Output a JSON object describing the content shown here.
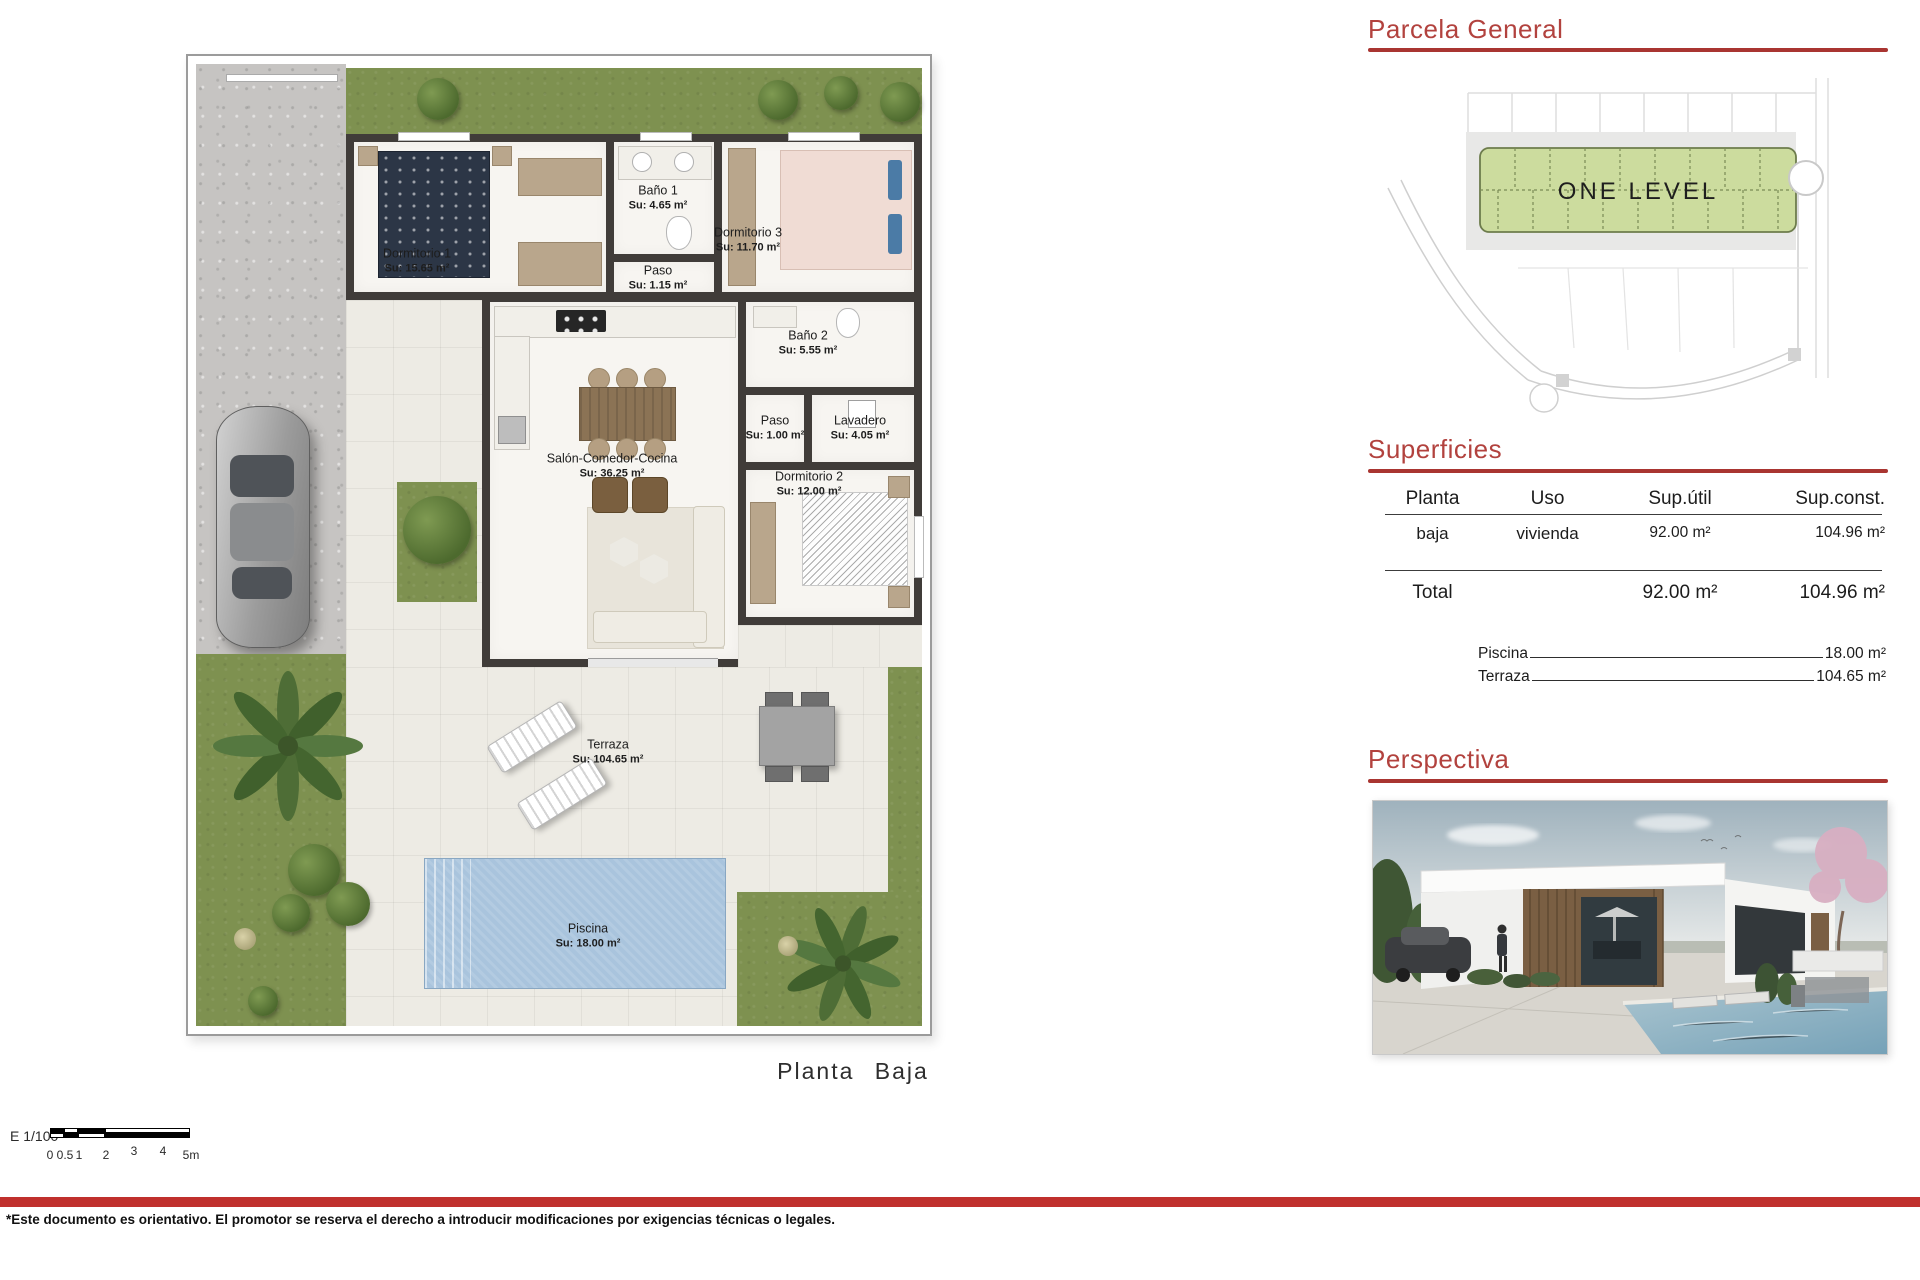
{
  "floor_plan": {
    "title": "Planta  Baja",
    "rooms": [
      {
        "name": "Dormitorio 1",
        "area": "Su: 15.65 m²"
      },
      {
        "name": "Baño 1",
        "area": "Su: 4.65 m²"
      },
      {
        "name": "Dormitorio 3",
        "area": "Su: 11.70 m²"
      },
      {
        "name": "Paso",
        "area": "Su: 1.15 m²"
      },
      {
        "name": "Baño 2",
        "area": "Su: 5.55 m²"
      },
      {
        "name": "Paso",
        "area": "Su: 1.00 m²"
      },
      {
        "name": "Lavadero",
        "area": "Su: 4.05 m²"
      },
      {
        "name": "Salón-Comedor-Cocina",
        "area": "Su: 36.25 m²"
      },
      {
        "name": "Dormitorio 2",
        "area": "Su: 12.00 m²"
      },
      {
        "name": "Terraza",
        "area": "Su: 104.65 m²"
      },
      {
        "name": "Piscina",
        "area": "Su: 18.00 m²"
      }
    ]
  },
  "scale_bar": {
    "label": "E  1/100",
    "ticks": [
      "0",
      "0.5",
      "1",
      "2",
      "3",
      "4",
      "5m"
    ]
  },
  "disclaimer": "*Este documento es orientativo. El promotor se reserva el derecho a introducir modificaciones por exigencias técnicas o legales.",
  "parcela": {
    "title": "Parcela  General",
    "parcel_label": "ONE  LEVEL"
  },
  "superficies": {
    "title": "Superficies",
    "headers": [
      "Planta",
      "Uso",
      "Sup.útil",
      "Sup.const."
    ],
    "rows": [
      {
        "planta": "baja",
        "uso": "vivienda",
        "sup_util": "92.00  m²",
        "sup_const": "104.96  m²"
      }
    ],
    "total": {
      "label": "Total",
      "sup_util": "92.00  m²",
      "sup_const": "104.96  m²"
    },
    "extras": [
      {
        "label": "Piscina",
        "value": "18.00  m²"
      },
      {
        "label": "Terraza",
        "value": "104.65  m²"
      }
    ]
  },
  "perspectiva": {
    "title": "Perspectiva"
  },
  "colors": {
    "accent_red": "#b2423e",
    "rule_red": "#a93531",
    "band_red": "#c0302d",
    "wall": "#403c39",
    "grass": "#7e9150",
    "pool": "#a9c4dd",
    "parcel_green": "#ccdc9e"
  }
}
